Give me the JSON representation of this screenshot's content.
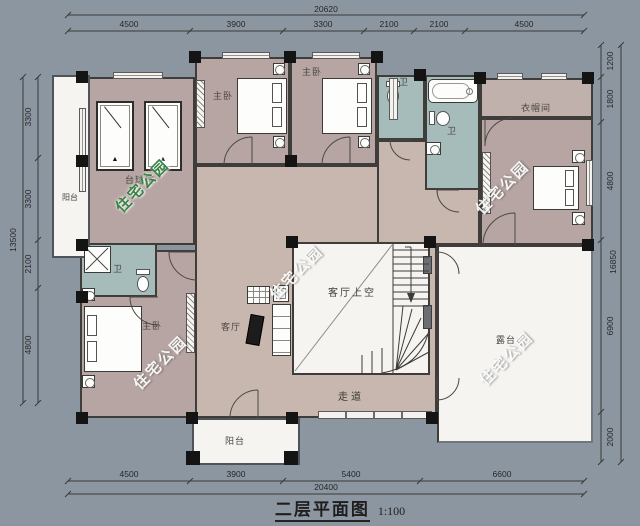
{
  "title": {
    "text": "二层平面图",
    "scale": "1:100"
  },
  "dimensions": {
    "top": {
      "total": "20620",
      "segments": [
        "4500",
        "3900",
        "3300",
        "2100",
        "2100",
        "4500"
      ]
    },
    "bottom": {
      "total": "20400",
      "segments": [
        "4500",
        "3900",
        "5400",
        "6600"
      ]
    },
    "left": {
      "total": "13500",
      "segments": [
        "3300",
        "3300",
        "2100",
        "4800"
      ]
    },
    "right": {
      "total": "16850",
      "segments": [
        "1200",
        "1800",
        "4800",
        "6900",
        "2000"
      ]
    }
  },
  "rooms": {
    "left_balcony": "阳台",
    "billiard_room": "台球室",
    "master_bedroom_top_left": "主卧",
    "master_bedroom_top_right": "主卧",
    "bath_small": "卫",
    "bath_large": "卫",
    "cloakroom": "衣帽间",
    "living_void": "客厅上空",
    "living_room": "客厅",
    "corridor": "走道",
    "terrace": "露台",
    "master_bedroom_lower": "主卧",
    "bath_lower": "卫",
    "bottom_balcony": "阳台"
  },
  "watermark": "住宅公园",
  "colors": {
    "background": "#8C96A0",
    "bedroom_floor": "#B6A5A2",
    "hall_floor": "#C7B7AE",
    "bath_floor": "#A5BCBA",
    "outdoor_floor": "#F5F4F0",
    "wall": "#3F3D3A",
    "watermark_green": "#2F7D3E"
  }
}
